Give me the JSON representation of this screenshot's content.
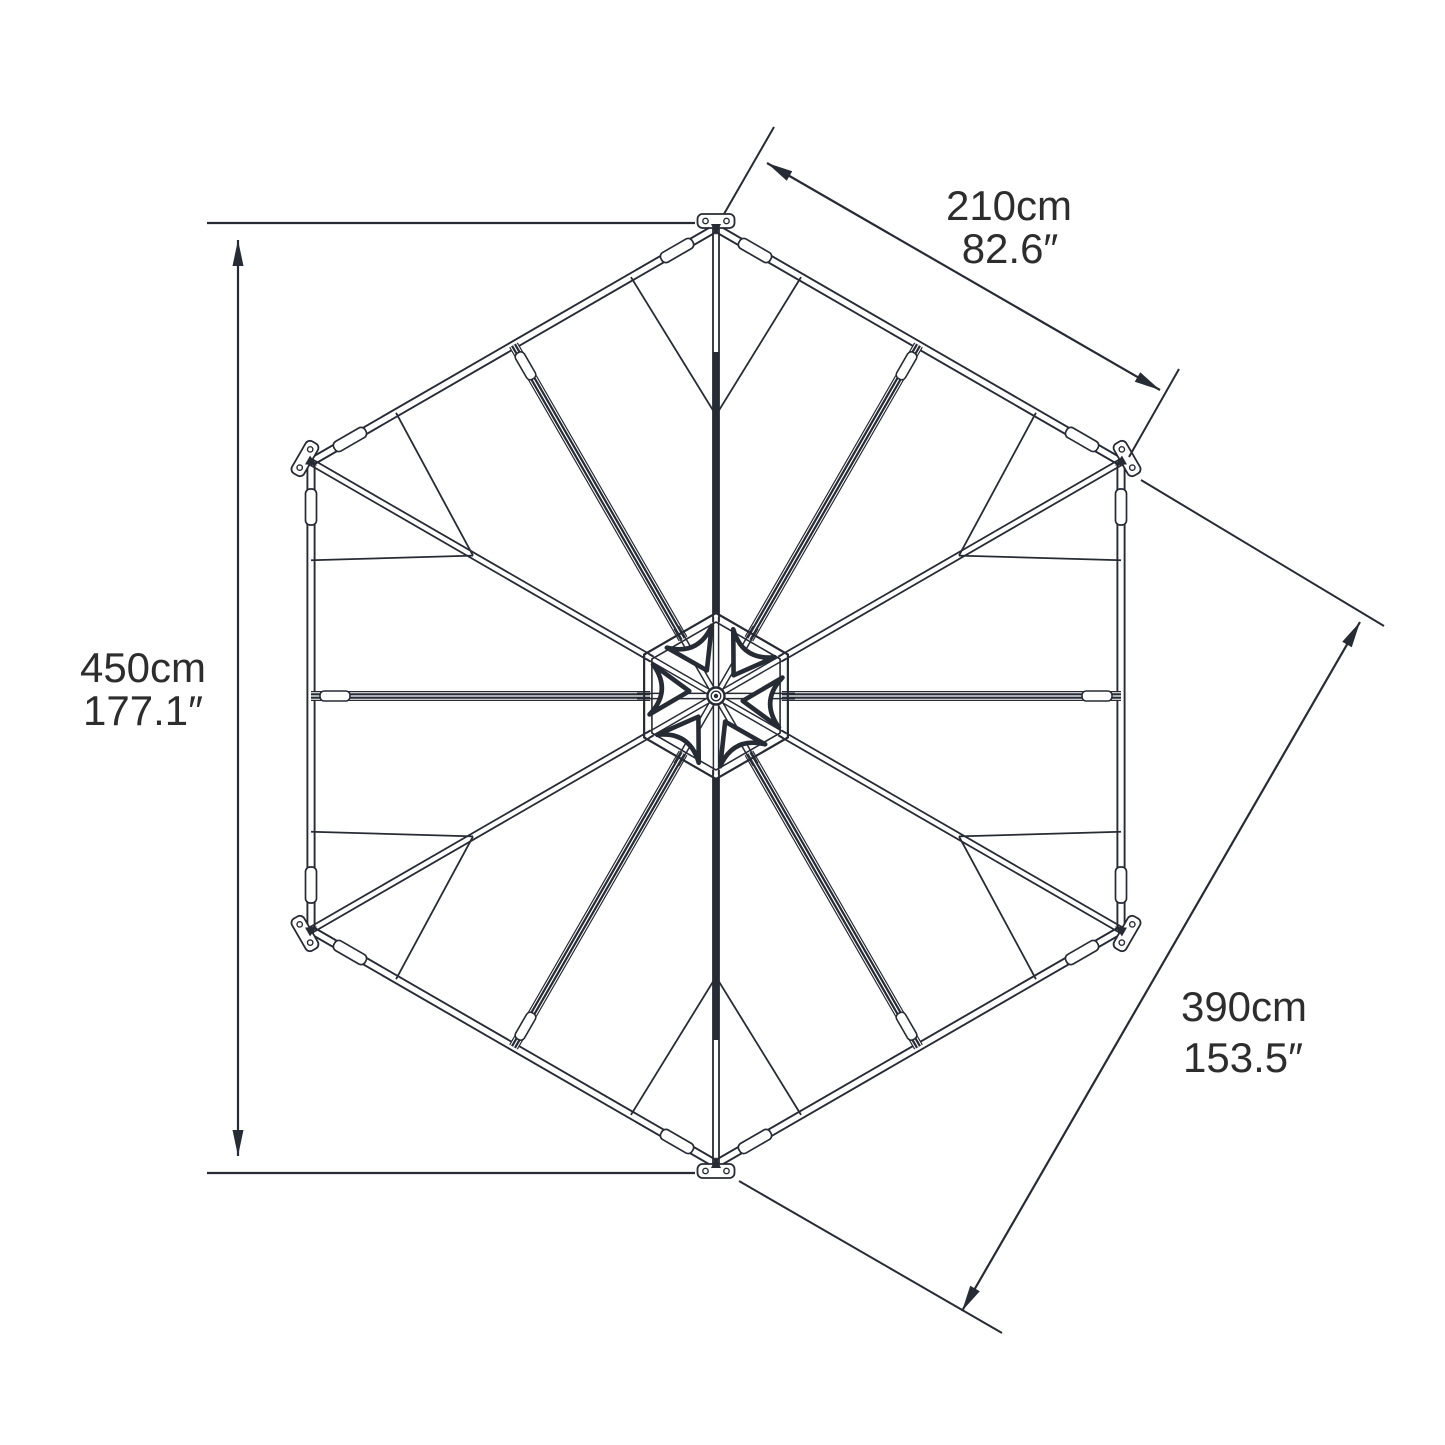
{
  "diagram": {
    "title": "hexagonal-gazebo-roof-top-view",
    "dimensions": {
      "left": {
        "cm": "450cm",
        "inch": "177.1″"
      },
      "top_right": {
        "cm": "210cm",
        "inch": "82.6″"
      },
      "bottom_right": {
        "cm": "390cm",
        "inch": "153.5″"
      }
    }
  },
  "colors": {
    "ink": "#272b34",
    "text": "#2d2d2d",
    "background": "#ffffff"
  }
}
